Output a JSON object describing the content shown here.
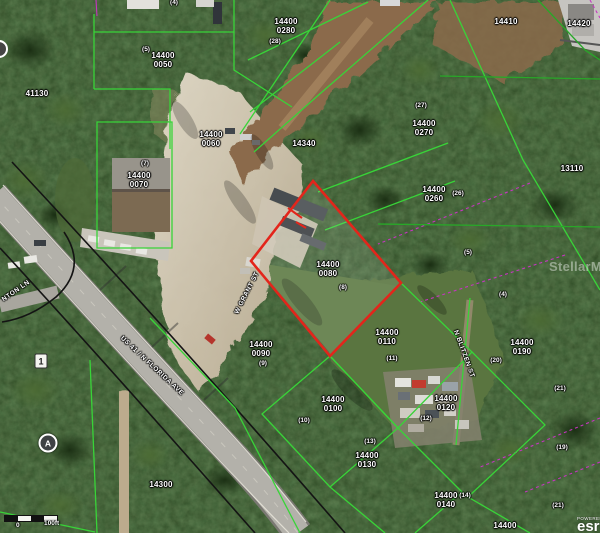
{
  "map": {
    "colors": {
      "highlight_outline": "#e3251b",
      "parcel_boundary": "#38d438",
      "survey_line": "#c535c0",
      "row_line": "#141414"
    },
    "highlighted_parcel": "14400 0080"
  },
  "parcel_labels": [
    {
      "line1": "14400",
      "line2": "0050",
      "x": 163,
      "y": 52
    },
    {
      "line1": "14400",
      "line2": "0060",
      "x": 211,
      "y": 131
    },
    {
      "line1": "14400",
      "line2": "0070",
      "x": 139,
      "y": 172
    },
    {
      "line1": "14400",
      "line2": "0280",
      "x": 286,
      "y": 18
    },
    {
      "line1": "14400",
      "line2": "0270",
      "x": 424,
      "y": 120
    },
    {
      "line1": "14400",
      "line2": "0260",
      "x": 434,
      "y": 186
    },
    {
      "line1": "14400",
      "line2": "0080",
      "x": 328,
      "y": 261
    },
    {
      "line1": "14400",
      "line2": "0110",
      "x": 387,
      "y": 329
    },
    {
      "line1": "14400",
      "line2": "0090",
      "x": 261,
      "y": 341
    },
    {
      "line1": "14400",
      "line2": "0100",
      "x": 333,
      "y": 396
    },
    {
      "line1": "14400",
      "line2": "0130",
      "x": 367,
      "y": 452
    },
    {
      "line1": "14400",
      "line2": "0120",
      "x": 446,
      "y": 395
    },
    {
      "line1": "14400",
      "line2": "0190",
      "x": 522,
      "y": 339
    },
    {
      "line1": "14400",
      "line2": "0140",
      "x": 446,
      "y": 492
    },
    {
      "line1": "41130",
      "line2": "",
      "x": 37,
      "y": 90
    },
    {
      "line1": "14410",
      "line2": "",
      "x": 506,
      "y": 18
    },
    {
      "line1": "14420",
      "line2": "",
      "x": 579,
      "y": 20
    },
    {
      "line1": "13110",
      "line2": "",
      "x": 572,
      "y": 165
    },
    {
      "line1": "14340",
      "line2": "",
      "x": 304,
      "y": 140
    },
    {
      "line1": "14300",
      "line2": "",
      "x": 161,
      "y": 481
    },
    {
      "line1": "14400",
      "line2": "",
      "x": 505,
      "y": 522
    }
  ],
  "count_markers": [
    {
      "text": "(4)",
      "x": 174,
      "y": -1
    },
    {
      "text": "(5)",
      "x": 146,
      "y": 46
    },
    {
      "text": "(28)",
      "x": 275,
      "y": 38
    },
    {
      "text": "(27)",
      "x": 421,
      "y": 102
    },
    {
      "text": "(26)",
      "x": 458,
      "y": 190
    },
    {
      "text": "(5)",
      "x": 468,
      "y": 249
    },
    {
      "text": "(4)",
      "x": 503,
      "y": 291
    },
    {
      "text": "(7)",
      "x": 145,
      "y": 160
    },
    {
      "text": "(8)",
      "x": 343,
      "y": 284
    },
    {
      "text": "(9)",
      "x": 263,
      "y": 360
    },
    {
      "text": "(10)",
      "x": 304,
      "y": 417
    },
    {
      "text": "(11)",
      "x": 392,
      "y": 355
    },
    {
      "text": "(13)",
      "x": 370,
      "y": 438
    },
    {
      "text": "(12)",
      "x": 426,
      "y": 415
    },
    {
      "text": "(20)",
      "x": 496,
      "y": 357
    },
    {
      "text": "(21)",
      "x": 560,
      "y": 385
    },
    {
      "text": "(19)",
      "x": 562,
      "y": 444
    },
    {
      "text": "(21)",
      "x": 558,
      "y": 502
    },
    {
      "text": "(14)",
      "x": 465,
      "y": 492
    }
  ],
  "street_labels": [
    {
      "text": "US 41 / N FLORIDA AVE",
      "x": 152,
      "y": 366,
      "angle": 43
    },
    {
      "text": "W GRANT ST",
      "x": 247,
      "y": 293,
      "angle": -63
    },
    {
      "text": "N BLITZEN ST",
      "x": 464,
      "y": 354,
      "angle": 70
    },
    {
      "text": "NTON LN",
      "x": 16,
      "y": 291,
      "angle": -35
    }
  ],
  "markers": [
    {
      "text": "1",
      "x": 41,
      "y": 361,
      "shape": "box"
    },
    {
      "text": "A",
      "x": 48,
      "y": 443,
      "shape": "circle"
    }
  ],
  "scale_bar": {
    "zero_label": "0",
    "distance_label": "100ft"
  },
  "watermarks": {
    "mls": "StellarMLS",
    "powered": "POWERED",
    "logo_text": "esri"
  }
}
